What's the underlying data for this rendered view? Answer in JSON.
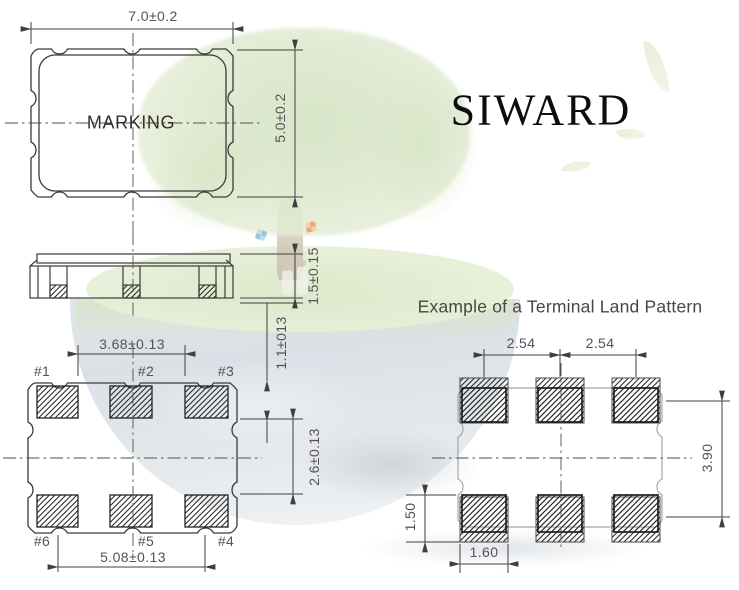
{
  "brand": {
    "logo_text": "SIWARD"
  },
  "package_top_view": {
    "marking_label": "MARKING",
    "dim_width": "7.0±0.2",
    "dim_height": "5.0±0.2"
  },
  "package_side_view": {
    "dim_thickness": "1.5±0.15"
  },
  "package_bottom_view": {
    "dim_pad_inner_span": "3.68±0.13",
    "dim_pad_outer_span": "5.08±0.13",
    "dim_pad_height": "1.1±013",
    "dim_pad_row_gap": "2.6±0.13",
    "pad_labels": [
      "#1",
      "#2",
      "#3",
      "#6",
      "#5",
      "#4"
    ]
  },
  "land_pattern": {
    "title": "Example of a Terminal Land Pattern",
    "dim_pitch_left": "2.54",
    "dim_pitch_right": "2.54",
    "dim_vertical_span": "3.90",
    "dim_pad_height": "1.50",
    "dim_pad_width": "1.60"
  },
  "colors": {
    "dimension_text": "#57505a",
    "drawing_line": "#3b3b3b",
    "brand_text": "#0d0d0d",
    "title_text": "#4b473f",
    "watermark_foliage": "#dce8cd",
    "watermark_earth": "#c9d3da"
  }
}
